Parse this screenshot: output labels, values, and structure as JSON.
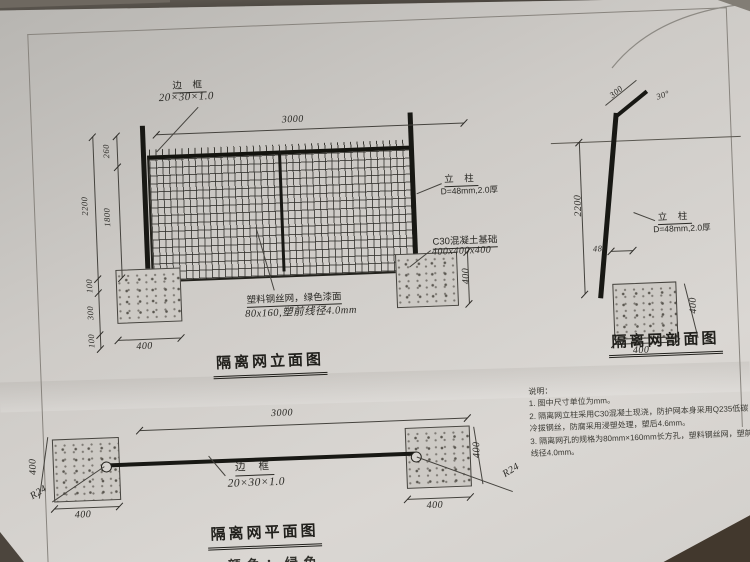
{
  "elevation": {
    "title": "隔离网立面图",
    "frame_label": "边 框",
    "frame_spec": "20×30×1.0",
    "dim_width": "3000",
    "dim_top": "260",
    "dim_mesh_h": "1800",
    "dim_total_h": "2200",
    "dim_e1": "100",
    "dim_e2": "300",
    "dim_e3": "100",
    "dim_found_w": "400",
    "dim_found_h": "400",
    "post_label": "立 柱",
    "post_spec": "D=48mm,2.0厚",
    "found_label": "C30混凝土基础",
    "found_spec": "400x400x400",
    "mesh_label": "塑料钢丝网，绿色漆面",
    "mesh_spec": "80x160,塑前线径4.0mm"
  },
  "section": {
    "title": "隔离网剖面图",
    "dim_bend": "300",
    "bend_angle": "30°",
    "dim_height": "2200",
    "dim_post": "48",
    "post_label": "立 柱",
    "post_spec": "D=48mm,2.0厚",
    "dim_found_w": "400",
    "dim_found_h": "400"
  },
  "plan": {
    "title": "隔离网平面图",
    "dim_width": "3000",
    "frame_label": "边 框",
    "frame_spec": "20×30×1.0",
    "radius_label": "R24",
    "dim_found_w": "400",
    "dim_found_side": "400",
    "partial_bottom_text": "颜色：绿色"
  },
  "notes": {
    "heading": "说明：",
    "items": [
      "1. 图中尺寸单位为mm。",
      "2. 隔离网立柱采用C30混凝土现浇，防护网本身采用Q235低碳冷拔钢丝，防腐采用浸塑处理，塑后4.6mm。",
      "3. 隔离网孔的规格为80mm×160mm长方孔，塑料钢丝网，塑前线径4.0mm。"
    ]
  }
}
